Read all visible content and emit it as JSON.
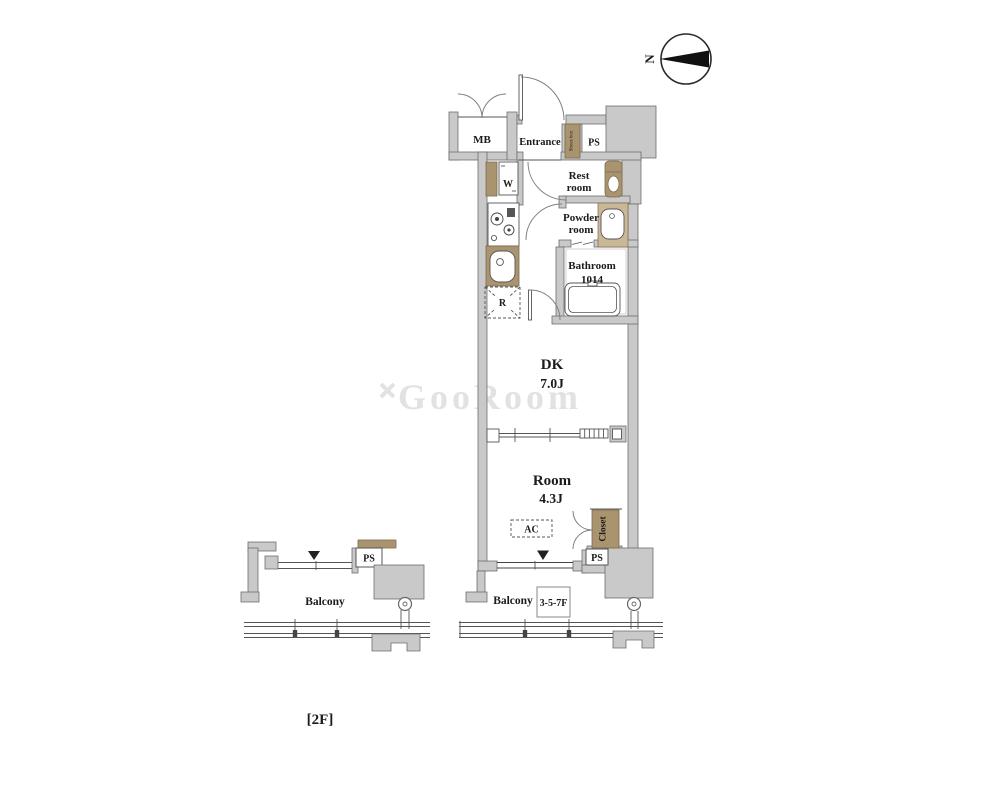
{
  "compass": {
    "north": "N"
  },
  "watermark": {
    "text": "GooRoom"
  },
  "floor_tag": {
    "text": "[2F]"
  },
  "unit": {
    "mb": "MB",
    "entrance": "Entrance",
    "shoes_box": "Shoes box",
    "ps_top": "PS",
    "rest_room": [
      "Rest",
      "room"
    ],
    "washer": "W",
    "powder_room": [
      "Powder",
      "room"
    ],
    "bathroom": [
      "Bathroom",
      "1014"
    ],
    "fridge": "R",
    "dk": [
      "DK",
      "7.0J"
    ],
    "room": [
      "Room",
      "4.3J"
    ],
    "ac": "AC",
    "closet": "Closet",
    "ps_bottom": "PS",
    "balcony": {
      "label": "Balcony",
      "floors": "3-5-7F"
    }
  },
  "left_balcony": {
    "label": "Balcony",
    "ps": "PS"
  },
  "colors": {
    "wall": "#c9c9c9",
    "wall_edge": "#6e6e6e",
    "fixture_brown": "#a9946f",
    "line": "#555555",
    "text": "#1b1b1b",
    "watermark": "#e2e2e2",
    "background": "#ffffff"
  }
}
